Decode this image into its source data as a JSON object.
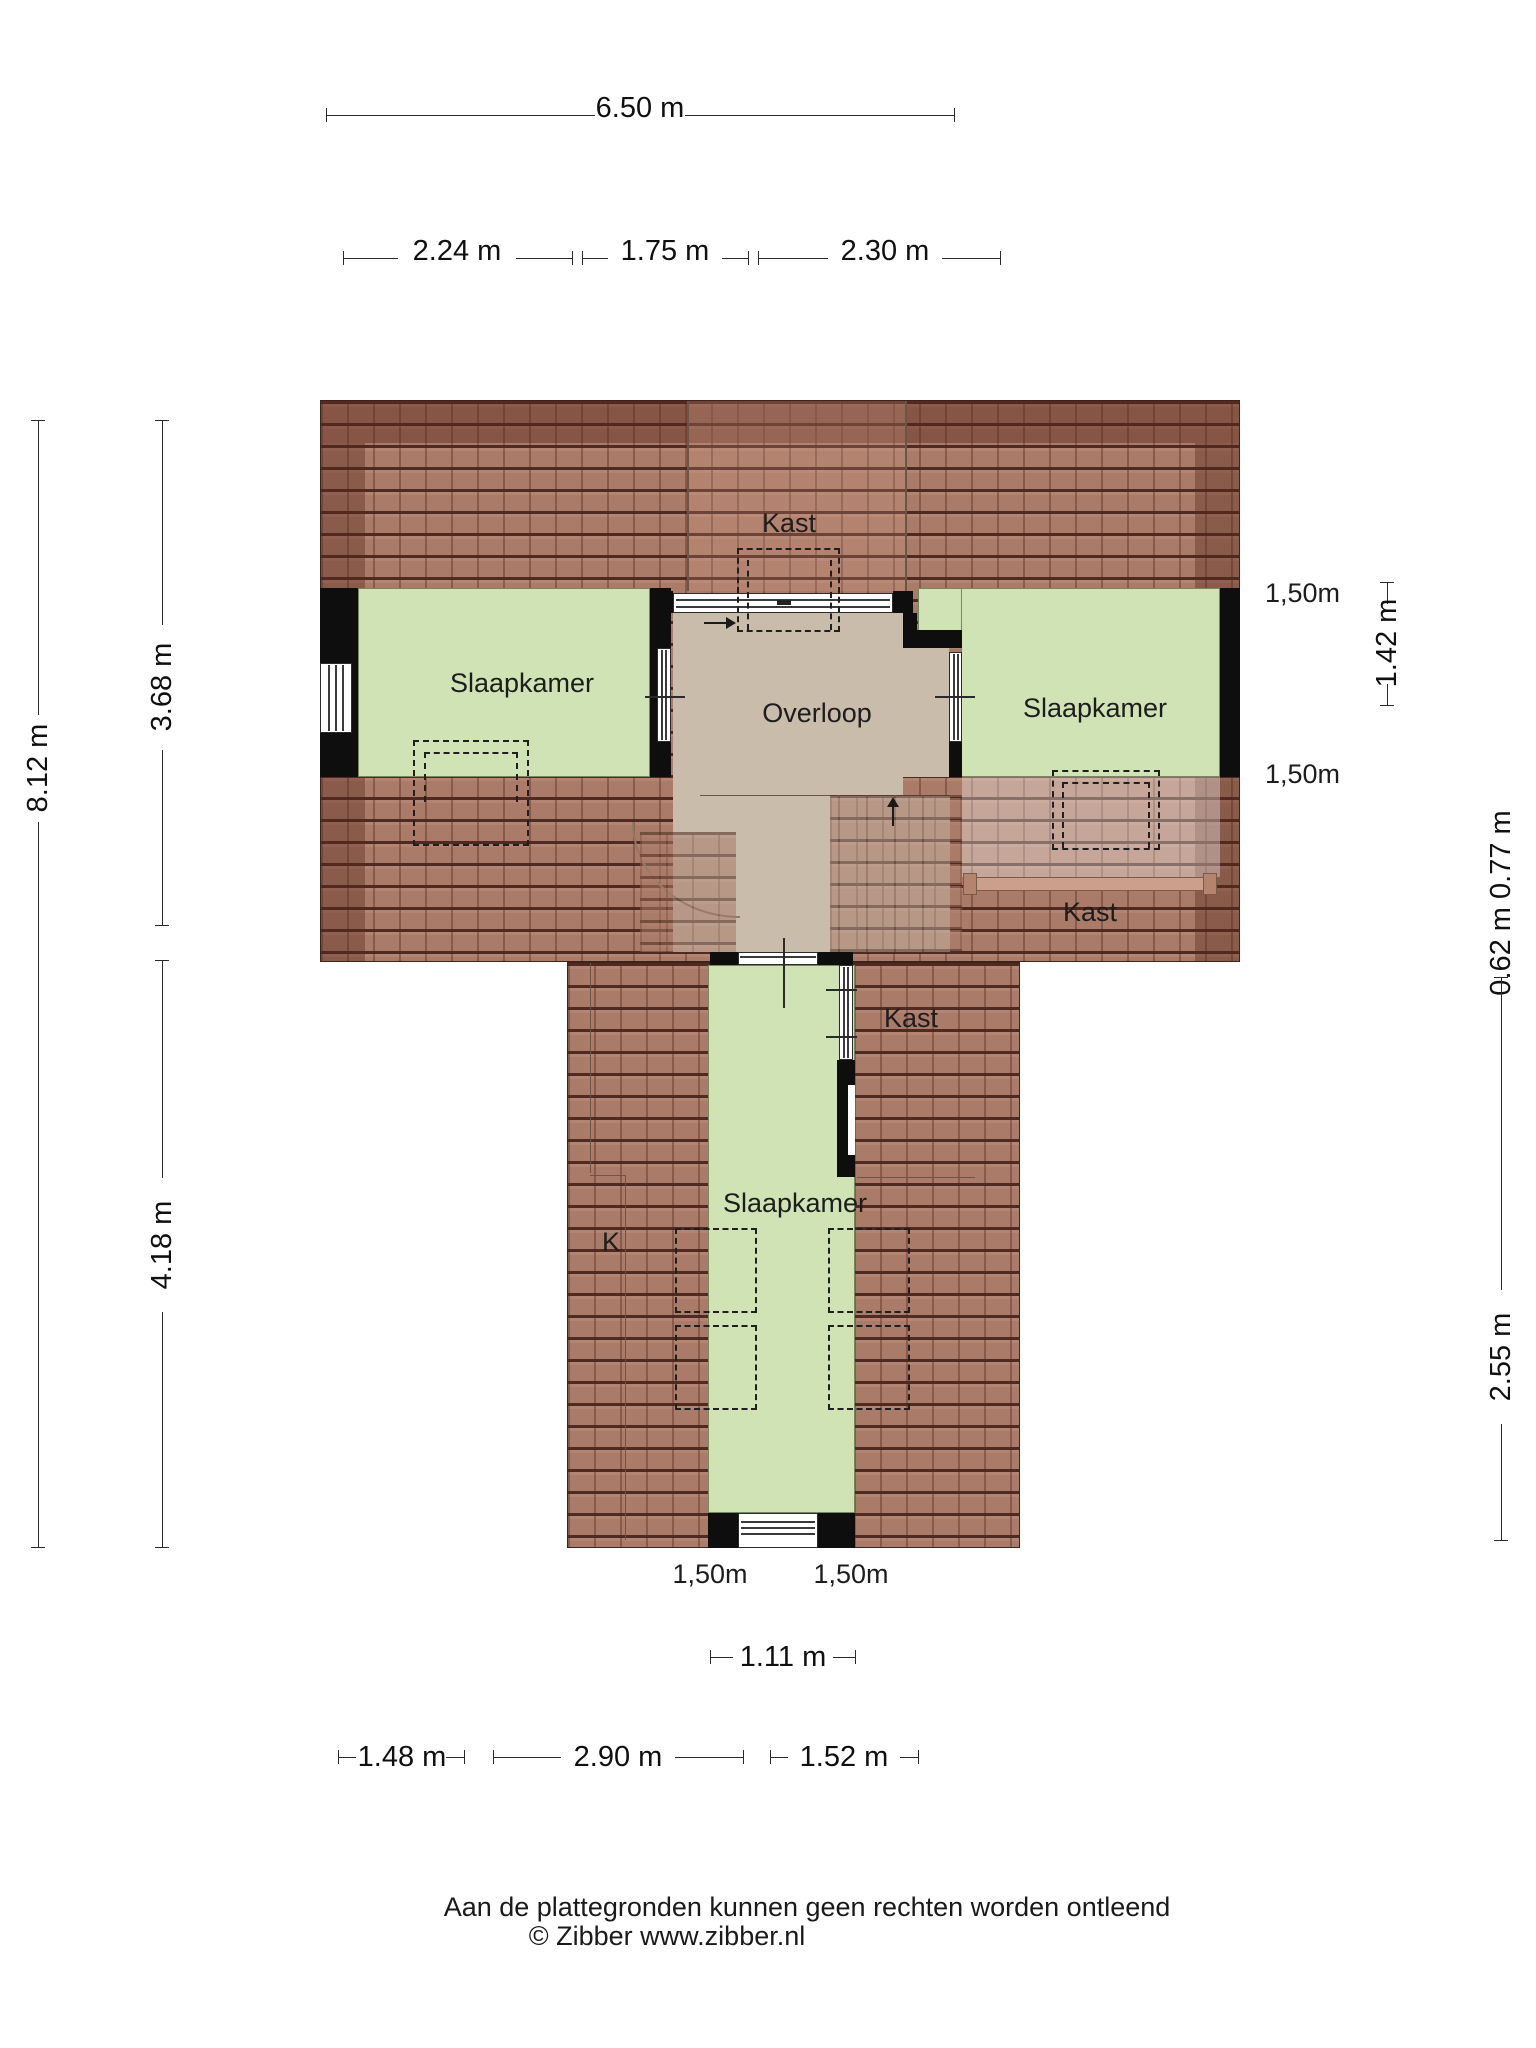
{
  "rooms": {
    "kast_top": "Kast",
    "slaapkamer_left": "Slaapkamer",
    "overloop": "Overloop",
    "slaapkamer_right": "Slaapkamer",
    "kast_right": "Kast",
    "kast_mid": "Kast",
    "slaapkamer_bottom": "Slaapkamer",
    "k_room": "K"
  },
  "clearances": {
    "right_top": "1,50m",
    "right_bottom": "1,50m",
    "bottom_left": "1,50m",
    "bottom_right": "1,50m"
  },
  "dimensions": {
    "top_total": "6.50 m",
    "top_left": "2.24 m",
    "top_mid": "1.75 m",
    "top_right": "2.30 m",
    "left_total": "8.12 m",
    "left_upper": "3.68 m",
    "left_lower": "4.18 m",
    "right_upper": "1.42 m",
    "right_mid": "0.62 m 0.77 m",
    "right_lower": "2.55 m",
    "stem_window": "1.11 m",
    "bottom_left": "1.48 m",
    "bottom_mid": "2.90 m",
    "bottom_right": "1.52 m"
  },
  "footer": {
    "line1": "Aan de plattegronden kunnen geen rechten worden ontleend",
    "line2": "© Zibber www.zibber.nl"
  },
  "colors": {
    "roof_tile": "#a97b68",
    "roof_line": "#3e1c14",
    "room_green": "#cfe3b5",
    "landing_tan": "#c9bcab",
    "wall_black": "#0e0e0e"
  }
}
